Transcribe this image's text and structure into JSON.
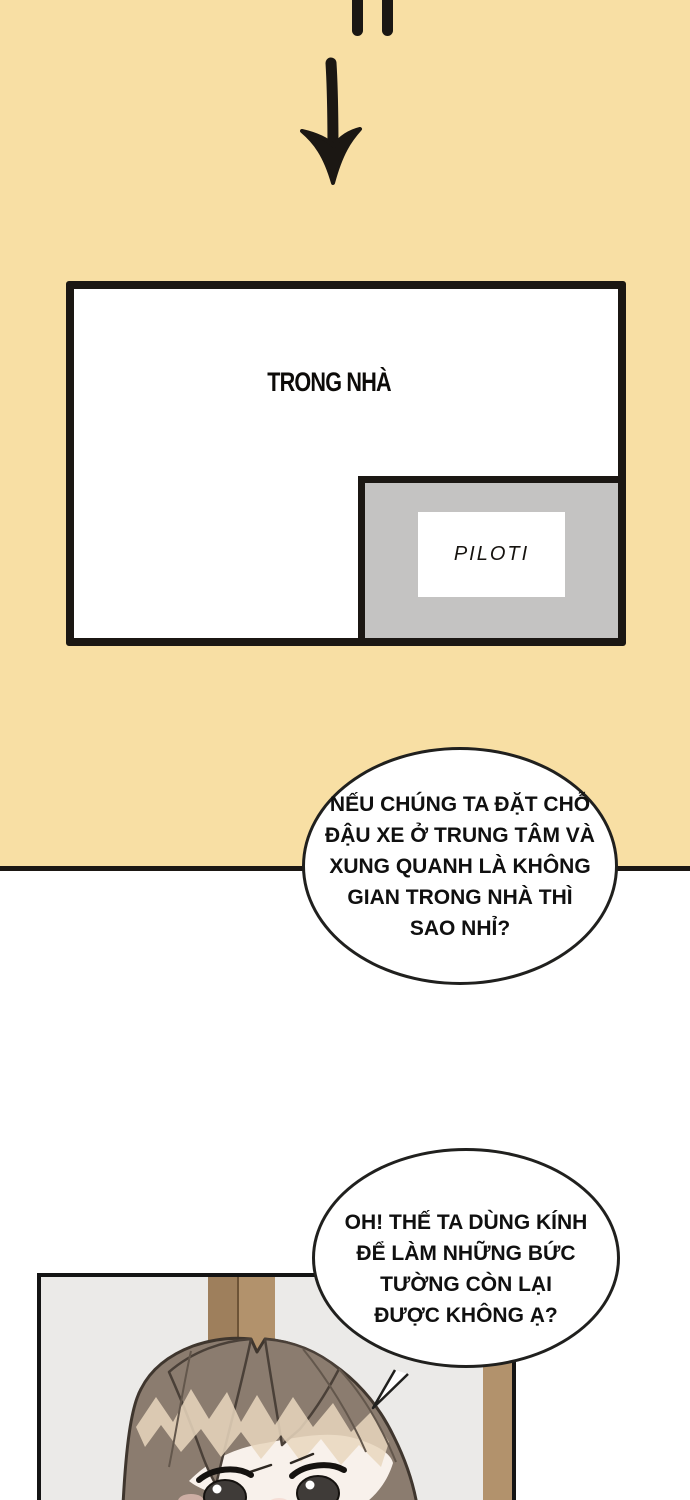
{
  "colors": {
    "tan": "#F8DFA4",
    "ink": "#1B1713",
    "panel-gray": "#EBEAE8",
    "diagram-gray": "#C4C3C2",
    "wood": "#B2926C",
    "wood-dark": "#9E7F5C",
    "hair": "#8B7C6F",
    "hair-outline": "#3F362E",
    "hair-strand": "#63574C",
    "hair-highlight": "#E9D7BE",
    "skin": "#F8F1EB",
    "blush": "#F1C9C0"
  },
  "diagram": {
    "main_label": "TRONG NHÀ",
    "inset_label": "PILOTI"
  },
  "bubble1": {
    "lines": [
      "NẾU CHÚNG TA ĐẶT CHỖ",
      "ĐẬU XE Ở TRUNG TÂM VÀ",
      "XUNG QUANH LÀ KHÔNG",
      "GIAN TRONG NHÀ THÌ",
      "SAO NHỈ?"
    ]
  },
  "bubble2": {
    "lines": [
      "OH! THẾ TA DÙNG KÍNH",
      "ĐỂ LÀM NHỮNG BỨC",
      "TƯỜNG CÒN LẠI",
      "ĐƯỢC KHÔNG Ạ?"
    ]
  }
}
